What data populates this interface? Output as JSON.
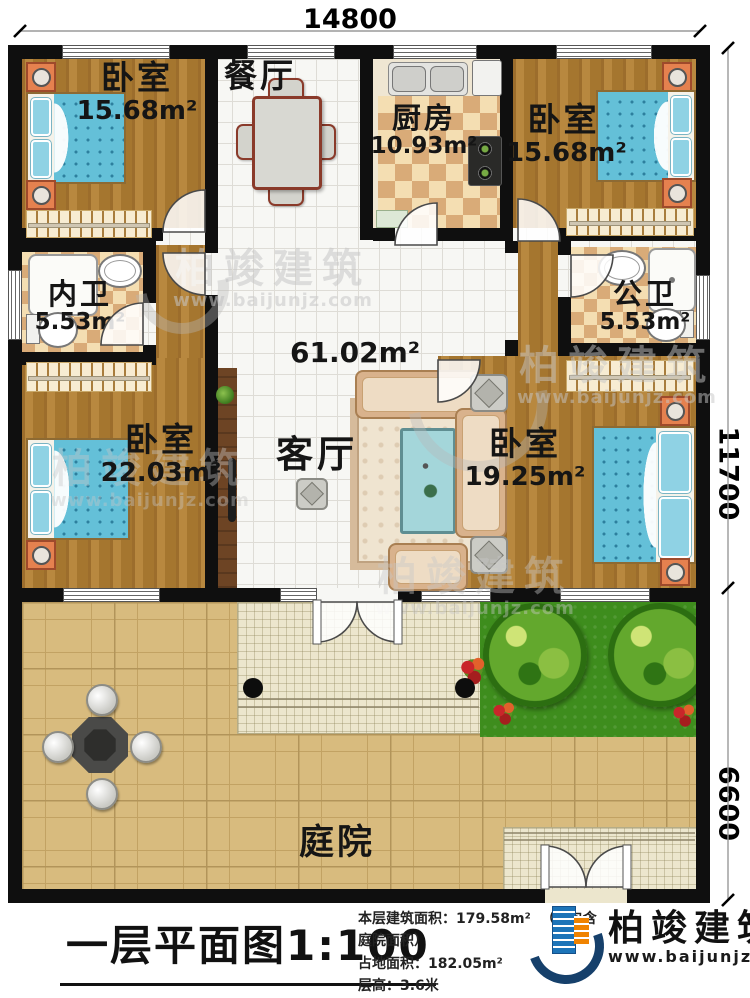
{
  "dimensions": {
    "top": "14800",
    "right_upper": "11700",
    "right_lower": "6600"
  },
  "rooms": {
    "bedroom_tl": {
      "name": "卧室",
      "area": "15.68m²"
    },
    "dining": {
      "name": "餐厅"
    },
    "kitchen": {
      "name": "厨房",
      "area": "10.93m²"
    },
    "bedroom_tr": {
      "name": "卧室",
      "area": "15.68m²"
    },
    "bath_inner": {
      "name": "内卫",
      "area": "5.53m²"
    },
    "bath_public": {
      "name": "公卫",
      "area": "5.53m²"
    },
    "bedroom_bl": {
      "name": "卧室",
      "area": "22.03m²"
    },
    "bedroom_br": {
      "name": "卧室",
      "area": "19.25m²"
    },
    "living": {
      "name": "客厅",
      "area": "61.02m²"
    },
    "courtyard": {
      "name": "庭院"
    }
  },
  "titleblock": {
    "title": "一层平面图",
    "scale": "1:100",
    "floor_area_label": "本层建筑面积：",
    "floor_area_value": "179.58m²",
    "floor_area_note": "（不包含庭院面积）",
    "land_area_label": "占地面积：",
    "land_area_value": "182.05m²",
    "height_label": "层高：",
    "height_value": "3.6米"
  },
  "brand": {
    "name": "柏竣建筑",
    "url": "www.baijunjz.com"
  },
  "watermark": {
    "name": "柏竣建筑",
    "url": "www.baijunjz.com"
  }
}
